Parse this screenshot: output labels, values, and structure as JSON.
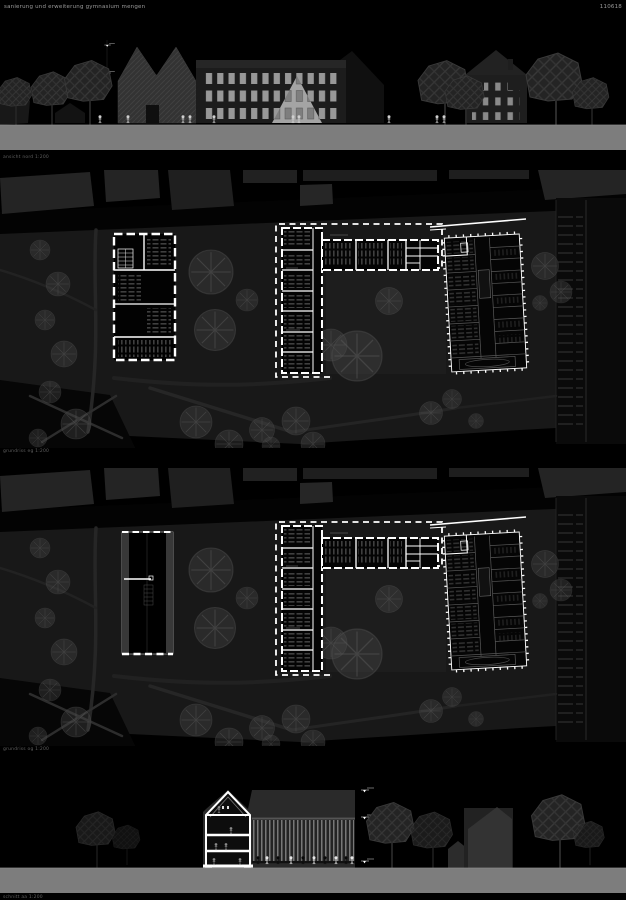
{
  "header": {
    "project_title": "sanierung und erweiterung gymnasium mengen",
    "sheet_number": "110618"
  },
  "panels": {
    "elevation": {
      "label": "ansicht nord 1:200"
    },
    "plan_eg": {
      "label": "grundriss eg 1:200"
    },
    "plan_og": {
      "label": "grundriss og 1:200"
    },
    "section": {
      "label": "schnitt aa 1:200"
    }
  },
  "colors": {
    "background": "#000000",
    "ground_band": "#7d7d7d",
    "plan_walls": "#ffffff",
    "site_ground": "#181818",
    "building_mass": "#232323",
    "window_light": "#989898"
  }
}
